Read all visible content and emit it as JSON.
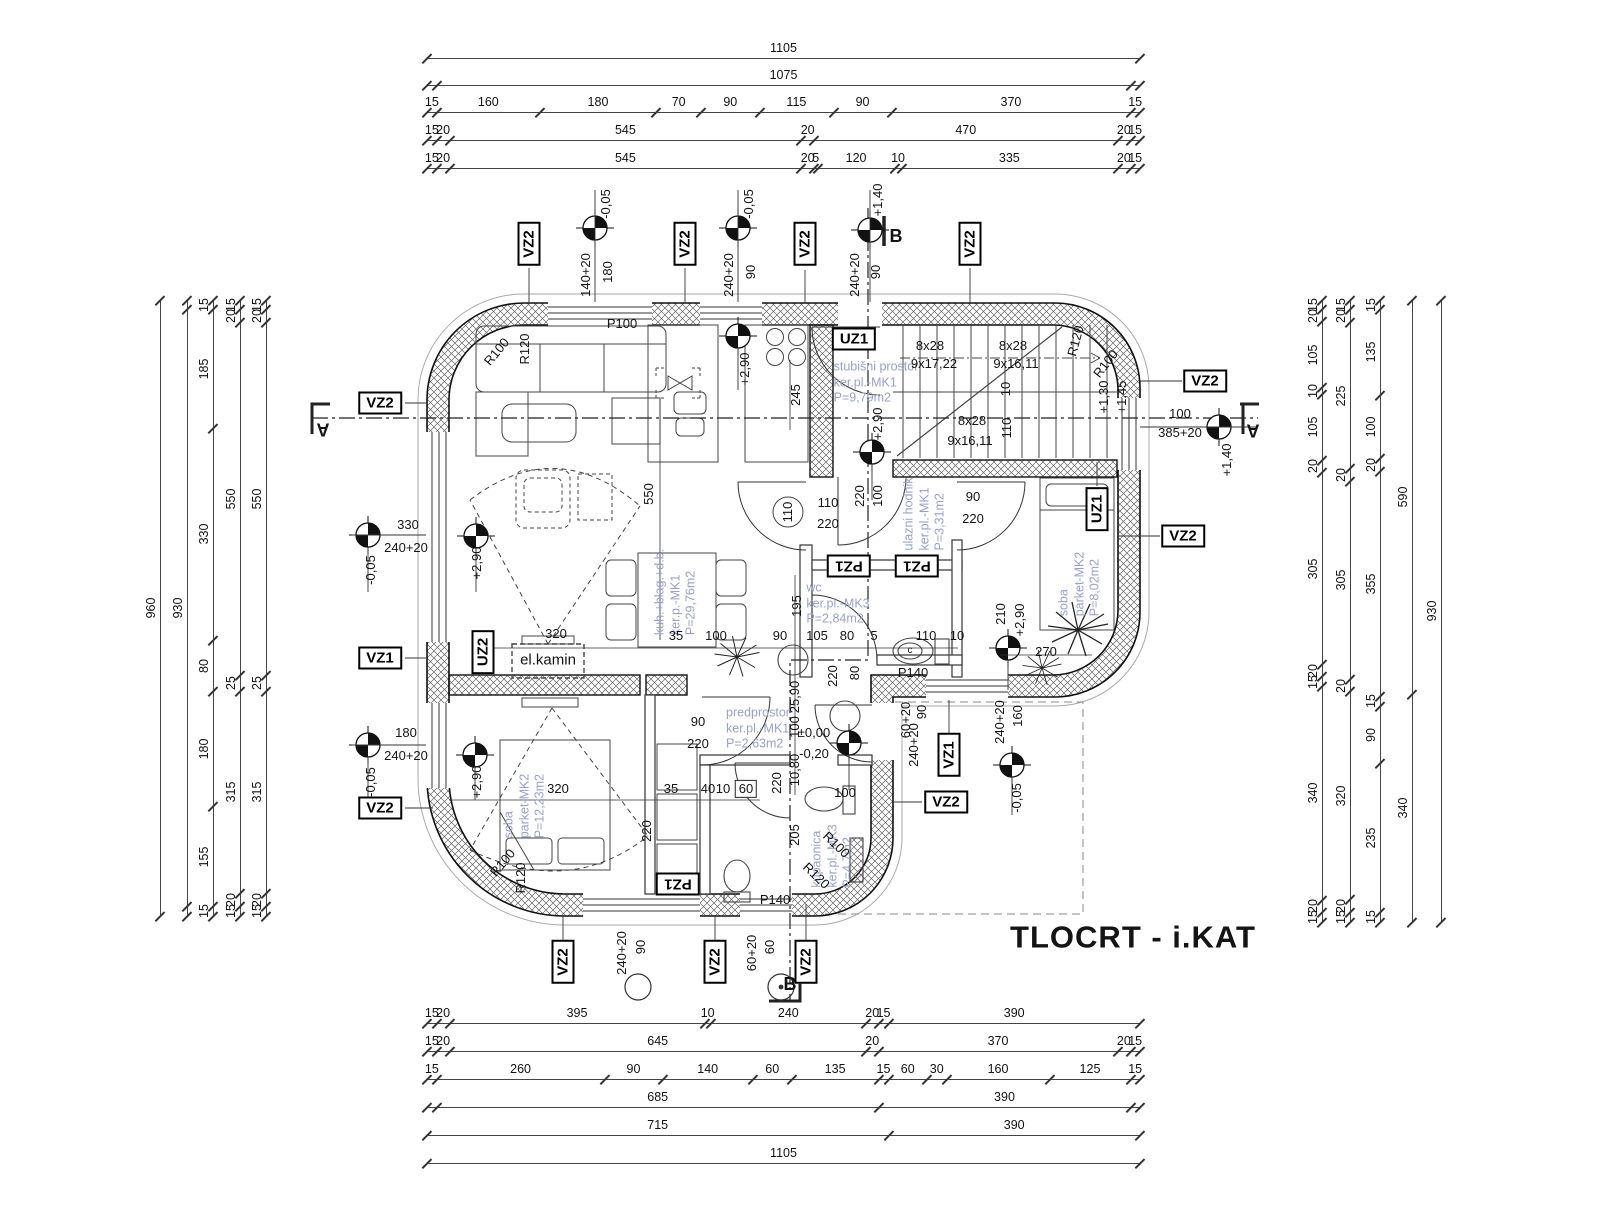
{
  "title": "TLOCRT - i.KAT",
  "colors": {
    "wall_line": "#111111",
    "room_label": "#99a2c6",
    "dim": "#141414",
    "hatch": "#666666"
  },
  "chains": {
    "top": [
      {
        "o": "h",
        "x": 427,
        "y": 58,
        "len": 713,
        "segs": [
          1105
        ]
      },
      {
        "o": "h",
        "x": 427,
        "y": 85,
        "len": 713,
        "segs": [
          [
            15,
            ""
          ],
          1075,
          [
            15,
            ""
          ]
        ]
      },
      {
        "o": "h",
        "x": 427,
        "y": 112,
        "len": 713,
        "segs": [
          15,
          160,
          180,
          70,
          90,
          115,
          90,
          370,
          15
        ]
      },
      {
        "o": "h",
        "x": 427,
        "y": 140,
        "len": 713,
        "segs": [
          15,
          20,
          545,
          20,
          470,
          20,
          15
        ]
      },
      {
        "o": "h",
        "x": 427,
        "y": 168,
        "len": 713,
        "segs": [
          15,
          20,
          545,
          20,
          5,
          120,
          10,
          335,
          20,
          15
        ]
      }
    ],
    "bottom": [
      {
        "o": "h",
        "x": 427,
        "y": 1023,
        "len": 713,
        "segs": [
          15,
          20,
          395,
          10,
          240,
          20,
          15,
          390
        ]
      },
      {
        "o": "h",
        "x": 427,
        "y": 1051,
        "len": 713,
        "segs": [
          15,
          20,
          645,
          20,
          370,
          20,
          15
        ]
      },
      {
        "o": "h",
        "x": 427,
        "y": 1079,
        "len": 713,
        "segs": [
          15,
          260,
          90,
          140,
          60,
          135,
          15,
          60,
          30,
          160,
          125,
          15
        ]
      },
      {
        "o": "h",
        "x": 427,
        "y": 1107,
        "len": 713,
        "segs": [
          [
            15,
            ""
          ],
          685,
          390,
          [
            15,
            ""
          ]
        ]
      },
      {
        "o": "h",
        "x": 427,
        "y": 1135,
        "len": 713,
        "segs": [
          715,
          390
        ]
      },
      {
        "o": "h",
        "x": 427,
        "y": 1163,
        "len": 713,
        "segs": [
          1105
        ]
      }
    ],
    "left": [
      {
        "o": "v",
        "x": 160,
        "y": 300,
        "len": 616,
        "segs": [
          960
        ]
      },
      {
        "o": "v",
        "x": 187,
        "y": 300,
        "len": 616,
        "segs": [
          [
            15,
            ""
          ],
          930,
          [
            15,
            ""
          ]
        ]
      },
      {
        "o": "v",
        "x": 213,
        "y": 300,
        "len": 616,
        "segs": [
          15,
          185,
          330,
          80,
          180,
          155,
          15
        ]
      },
      {
        "o": "v",
        "x": 240,
        "y": 300,
        "len": 616,
        "segs": [
          15,
          20,
          550,
          25,
          315,
          20,
          15
        ]
      },
      {
        "o": "v",
        "x": 266,
        "y": 300,
        "len": 616,
        "segs": [
          15,
          20,
          550,
          25,
          315,
          20,
          15
        ]
      }
    ],
    "right": [
      {
        "o": "v",
        "x": 1322,
        "y": 300,
        "len": 622,
        "segs": [
          15,
          20,
          105,
          10,
          105,
          20,
          305,
          20,
          15,
          340,
          20,
          15
        ]
      },
      {
        "o": "v",
        "x": 1350,
        "y": 300,
        "len": 622,
        "segs": [
          15,
          20,
          225,
          20,
          305,
          20,
          320,
          20,
          15
        ]
      },
      {
        "o": "v",
        "x": 1380,
        "y": 300,
        "len": 622,
        "segs": [
          15,
          135,
          100,
          20,
          355,
          15,
          90,
          235,
          15
        ]
      },
      {
        "o": "v",
        "x": 1412,
        "y": 300,
        "len": 622,
        "segs": [
          590,
          340
        ]
      },
      {
        "o": "v",
        "x": 1441,
        "y": 300,
        "len": 622,
        "segs": [
          930
        ]
      }
    ]
  },
  "labels": [
    {
      "t": "-0,05",
      "x": 606,
      "y": 204,
      "r": -90
    },
    {
      "t": "140+20",
      "x": 586,
      "y": 275,
      "r": -90
    },
    {
      "t": "180",
      "x": 608,
      "y": 272,
      "r": -90
    },
    {
      "t": "-0,05",
      "x": 749,
      "y": 204,
      "r": -90
    },
    {
      "t": "240+20",
      "x": 729,
      "y": 275,
      "r": -90
    },
    {
      "t": "90",
      "x": 751,
      "y": 272,
      "r": -90
    },
    {
      "t": "+1,40",
      "x": 878,
      "y": 200,
      "r": -90
    },
    {
      "t": "240+20",
      "x": 855,
      "y": 275,
      "r": -90
    },
    {
      "t": "90",
      "x": 876,
      "y": 272,
      "r": -90
    },
    {
      "t": "B",
      "x": 896,
      "y": 236,
      "s": "sec"
    },
    {
      "t": "VZ2",
      "x": 529,
      "y": 244,
      "r": -90,
      "s": "box"
    },
    {
      "t": "VZ2",
      "x": 685,
      "y": 244,
      "r": -90,
      "s": "box"
    },
    {
      "t": "VZ2",
      "x": 805,
      "y": 244,
      "r": -90,
      "s": "box"
    },
    {
      "t": "VZ2",
      "x": 970,
      "y": 244,
      "r": -90,
      "s": "box"
    },
    {
      "t": "VZ2",
      "x": 1205,
      "y": 381,
      "s": "box"
    },
    {
      "t": "R120",
      "x": 1076,
      "y": 341,
      "r": -75
    },
    {
      "t": "R100",
      "x": 1106,
      "y": 364,
      "r": -52
    },
    {
      "t": "+1,45",
      "x": 1122,
      "y": 397,
      "r": -90
    },
    {
      "t": "+1,30",
      "x": 1104,
      "y": 397,
      "r": -90
    },
    {
      "t": "100",
      "x": 1180,
      "y": 414
    },
    {
      "t": "385+20",
      "x": 1180,
      "y": 433
    },
    {
      "t": "+1,40",
      "x": 1227,
      "y": 460,
      "r": -90
    },
    {
      "t": "A",
      "x": 1253,
      "y": 430,
      "r": 180,
      "s": "sec"
    },
    {
      "t": "VZ2",
      "x": 1183,
      "y": 536,
      "s": "box"
    },
    {
      "t": "UZ1",
      "x": 854,
      "y": 339,
      "s": "box"
    },
    {
      "t": "stubišni prostor\nker.pl.-MK1\nP=9,79m2",
      "x": 876,
      "y": 383,
      "s": "room"
    },
    {
      "t": "8x28",
      "x": 930,
      "y": 346
    },
    {
      "t": "9x17,22",
      "x": 934,
      "y": 364
    },
    {
      "t": "8x28",
      "x": 1013,
      "y": 346
    },
    {
      "t": "9x16,11",
      "x": 1016,
      "y": 364
    },
    {
      "t": "8x28",
      "x": 972,
      "y": 421
    },
    {
      "t": "9x16,11",
      "x": 970,
      "y": 441
    },
    {
      "t": "10",
      "x": 1006,
      "y": 389,
      "r": -90
    },
    {
      "t": "110",
      "x": 1007,
      "y": 428,
      "r": -90
    },
    {
      "t": "+2,90",
      "x": 878,
      "y": 424,
      "r": -90
    },
    {
      "t": "245",
      "x": 796,
      "y": 395,
      "r": -90
    },
    {
      "t": "100",
      "x": 878,
      "y": 496,
      "r": -90
    },
    {
      "t": "220",
      "x": 860,
      "y": 496,
      "r": -90
    },
    {
      "t": "P100",
      "x": 622,
      "y": 324
    },
    {
      "t": "R120",
      "x": 525,
      "y": 349,
      "r": -90
    },
    {
      "t": "R100",
      "x": 497,
      "y": 352,
      "r": -50
    },
    {
      "t": "+2,90",
      "x": 745,
      "y": 369,
      "r": -90
    },
    {
      "t": "VZ2",
      "x": 380,
      "y": 403,
      "s": "box"
    },
    {
      "t": "A",
      "x": 323,
      "y": 429,
      "r": 180,
      "s": "sec"
    },
    {
      "t": "330",
      "x": 408,
      "y": 525
    },
    {
      "t": "240+20",
      "x": 406,
      "y": 548
    },
    {
      "t": "-0,05",
      "x": 371,
      "y": 570,
      "r": -90
    },
    {
      "t": "VZ1",
      "x": 380,
      "y": 658,
      "s": "box"
    },
    {
      "t": "180",
      "x": 406,
      "y": 733
    },
    {
      "t": "240+20",
      "x": 406,
      "y": 756
    },
    {
      "t": "-0,05",
      "x": 371,
      "y": 782,
      "r": -90
    },
    {
      "t": "VZ2",
      "x": 380,
      "y": 808,
      "s": "box"
    },
    {
      "t": "+2,90",
      "x": 477,
      "y": 563,
      "r": -90
    },
    {
      "t": "550",
      "x": 649,
      "y": 494,
      "r": -90
    },
    {
      "t": "kuh.+blag.+d.b.\nker.p.-MK1\nP=29,76m2",
      "x": 676,
      "y": 592,
      "r": -90,
      "s": "room"
    },
    {
      "t": "UZ2",
      "x": 483,
      "y": 652,
      "r": -90,
      "s": "box"
    },
    {
      "t": "el.kamin",
      "x": 548,
      "y": 661,
      "s": "plain"
    },
    {
      "t": "320",
      "x": 556,
      "y": 634
    },
    {
      "t": "35",
      "x": 676,
      "y": 636
    },
    {
      "t": "100",
      "x": 716,
      "y": 636
    },
    {
      "t": "90",
      "x": 780,
      "y": 636
    },
    {
      "t": "105",
      "x": 817,
      "y": 636
    },
    {
      "t": "80",
      "x": 847,
      "y": 636
    },
    {
      "t": "5",
      "x": 874,
      "y": 636
    },
    {
      "t": "110",
      "x": 926,
      "y": 636
    },
    {
      "t": "10",
      "x": 957,
      "y": 636
    },
    {
      "t": "195",
      "x": 797,
      "y": 606,
      "r": -90
    },
    {
      "t": "110",
      "x": 788,
      "y": 512,
      "r": -90
    },
    {
      "t": "110",
      "x": 828,
      "y": 503
    },
    {
      "t": "220",
      "x": 828,
      "y": 524
    },
    {
      "t": "ulazni hodnik\nker.pl.-MK1\nP=3,31m2",
      "x": 925,
      "y": 514,
      "r": -90,
      "s": "room"
    },
    {
      "t": "90",
      "x": 973,
      "y": 497
    },
    {
      "t": "220",
      "x": 973,
      "y": 519
    },
    {
      "t": "PZ1",
      "x": 849,
      "y": 566,
      "r": 180,
      "s": "box"
    },
    {
      "t": "PZ1",
      "x": 917,
      "y": 566,
      "r": 180,
      "s": "box"
    },
    {
      "t": "UZ1",
      "x": 1097,
      "y": 509,
      "r": -90,
      "s": "box"
    },
    {
      "t": "soba\nparket-MK2\nP=8,02m2",
      "x": 1080,
      "y": 584,
      "r": -90,
      "s": "room"
    },
    {
      "t": "210",
      "x": 1001,
      "y": 614,
      "r": -90
    },
    {
      "t": "+2,90",
      "x": 1020,
      "y": 620,
      "r": -90
    },
    {
      "t": "270",
      "x": 1046,
      "y": 652
    },
    {
      "t": "wc\nker.pl.-MK3\nP=2,84m2",
      "x": 838,
      "y": 604,
      "s": "room"
    },
    {
      "t": "c",
      "x": 910,
      "y": 651,
      "s": "tiny"
    },
    {
      "t": "220",
      "x": 833,
      "y": 676,
      "r": -90
    },
    {
      "t": "80",
      "x": 855,
      "y": 673,
      "r": -90
    },
    {
      "t": "P140",
      "x": 913,
      "y": 673
    },
    {
      "t": "predprostor\nker.pl.-MK1\nP=2,63m2",
      "x": 758,
      "y": 729,
      "s": "room"
    },
    {
      "t": "±0,00",
      "x": 814,
      "y": 733
    },
    {
      "t": "-0,20",
      "x": 814,
      "y": 754
    },
    {
      "t": "25,90",
      "x": 795,
      "y": 697,
      "r": -90
    },
    {
      "t": "100",
      "x": 795,
      "y": 727,
      "r": -90
    },
    {
      "t": "10,80",
      "x": 795,
      "y": 770,
      "r": -90
    },
    {
      "t": "220",
      "x": 777,
      "y": 783,
      "r": -90
    },
    {
      "t": "90",
      "x": 698,
      "y": 722
    },
    {
      "t": "220",
      "x": 698,
      "y": 744
    },
    {
      "t": "+2,90",
      "x": 477,
      "y": 782,
      "r": -90
    },
    {
      "t": "soba\nparket-MK2\nP=12,23m2",
      "x": 525,
      "y": 806,
      "r": -90,
      "s": "room"
    },
    {
      "t": "320",
      "x": 558,
      "y": 789
    },
    {
      "t": "35",
      "x": 671,
      "y": 789
    },
    {
      "t": "40",
      "x": 708,
      "y": 789
    },
    {
      "t": "10",
      "x": 723,
      "y": 789
    },
    {
      "t": "60",
      "x": 746,
      "y": 789,
      "s": "dimB"
    },
    {
      "t": "220",
      "x": 647,
      "y": 831,
      "r": -90
    },
    {
      "t": "PZ1",
      "x": 678,
      "y": 884,
      "r": 180,
      "s": "box"
    },
    {
      "t": "R120",
      "x": 521,
      "y": 878,
      "r": -90
    },
    {
      "t": "R100",
      "x": 503,
      "y": 863,
      "r": -50
    },
    {
      "t": "kupaonica\nker.pl.-MK3\nP=4,7m2",
      "x": 833,
      "y": 856,
      "r": -90,
      "s": "room"
    },
    {
      "t": "R100",
      "x": 836,
      "y": 845,
      "r": 44
    },
    {
      "t": "R120",
      "x": 816,
      "y": 876,
      "r": 44
    },
    {
      "t": "100",
      "x": 845,
      "y": 793
    },
    {
      "t": "205",
      "x": 795,
      "y": 835,
      "r": -90
    },
    {
      "t": "P140",
      "x": 775,
      "y": 900
    },
    {
      "t": "VZ2",
      "x": 946,
      "y": 802,
      "s": "box"
    },
    {
      "t": "VZ1",
      "x": 949,
      "y": 755,
      "r": -90,
      "s": "box"
    },
    {
      "t": "60+20",
      "x": 906,
      "y": 720,
      "r": -90
    },
    {
      "t": "90",
      "x": 922,
      "y": 712,
      "r": -90
    },
    {
      "t": "240+20",
      "x": 914,
      "y": 745,
      "r": -90
    },
    {
      "t": "240+20",
      "x": 1000,
      "y": 722,
      "r": -90
    },
    {
      "t": "160",
      "x": 1018,
      "y": 716,
      "r": -90
    },
    {
      "t": "-0,05",
      "x": 1017,
      "y": 798,
      "r": -90
    },
    {
      "t": "240+20",
      "x": 622,
      "y": 953,
      "r": -90
    },
    {
      "t": "90",
      "x": 641,
      "y": 947,
      "r": -90
    },
    {
      "t": "60+20",
      "x": 752,
      "y": 953,
      "r": -90
    },
    {
      "t": "60",
      "x": 770,
      "y": 947,
      "r": -90
    },
    {
      "t": "VZ2",
      "x": 563,
      "y": 962,
      "r": -90,
      "s": "box"
    },
    {
      "t": "VZ2",
      "x": 715,
      "y": 962,
      "r": -90,
      "s": "box"
    },
    {
      "t": "VZ2",
      "x": 806,
      "y": 962,
      "r": -90,
      "s": "box"
    },
    {
      "t": "B",
      "x": 790,
      "y": 984,
      "s": "sec"
    }
  ]
}
